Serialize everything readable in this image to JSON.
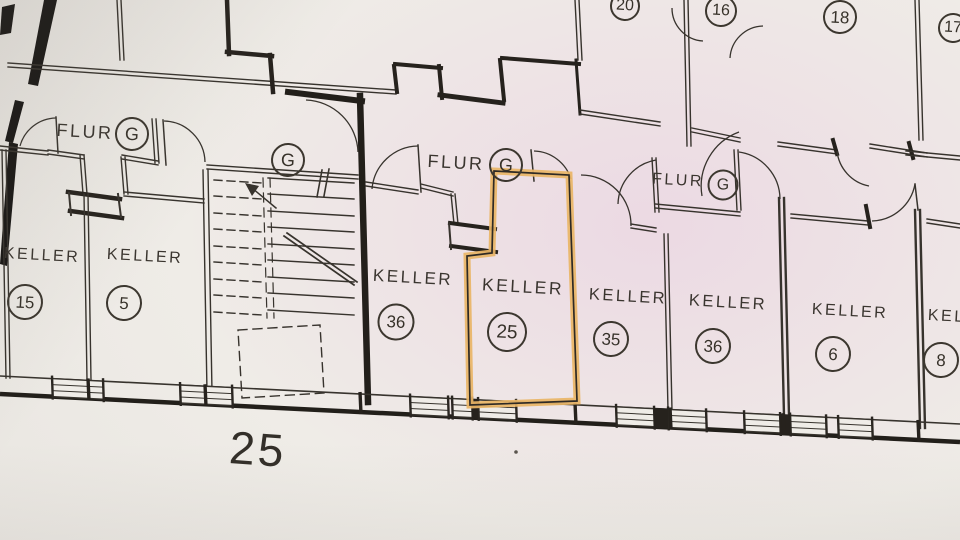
{
  "sheet": {
    "number": "25"
  },
  "corridor": {
    "label": "FLUR",
    "badge": "G"
  },
  "top_rooms": [
    {
      "number": "20"
    },
    {
      "number": "16"
    },
    {
      "number": "18"
    },
    {
      "number": "17"
    }
  ],
  "rooms": [
    {
      "label": "KELLER",
      "number": "15",
      "highlighted": false
    },
    {
      "label": "KELLER",
      "number": "5",
      "highlighted": false
    },
    {
      "label": "KELLER",
      "number": "36",
      "highlighted": false
    },
    {
      "label": "KELLER",
      "number": "25",
      "highlighted": true
    },
    {
      "label": "KELLER",
      "number": "35",
      "highlighted": false
    },
    {
      "label": "KELLER",
      "number": "36",
      "highlighted": false
    },
    {
      "label": "KELLER",
      "number": "6",
      "highlighted": false
    },
    {
      "label": "KELLER",
      "number": "8",
      "highlighted": false
    }
  ],
  "highlight": {
    "room": "25",
    "color": "#e9b566"
  }
}
